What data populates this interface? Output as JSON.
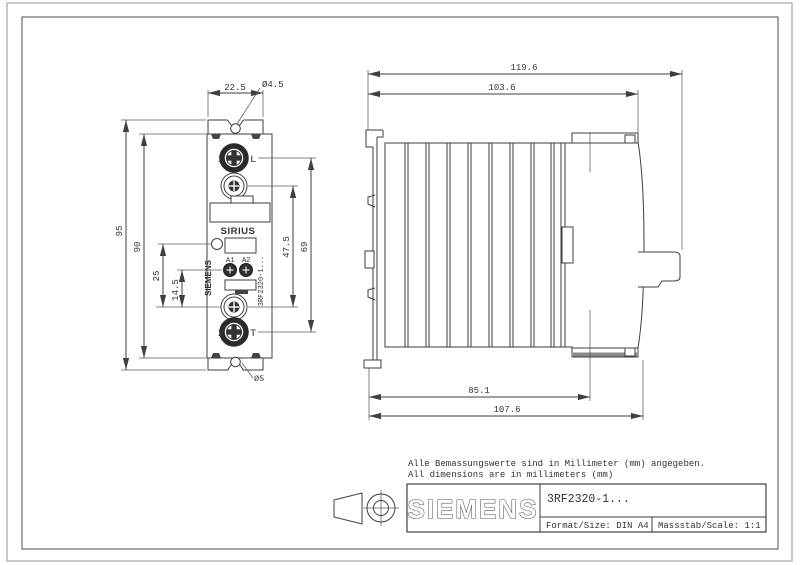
{
  "drawing": {
    "notes": {
      "de": "Alle Bemassungswerte sind in Millimeter (mm) angegeben.",
      "en": "All dimensions are in millimeters (mm)"
    },
    "front_view": {
      "dim_width_top": "22.5",
      "dim_hole_top": "Ø4.5",
      "dim_hole_bottom": "Ø5",
      "dim_height_overall": "95",
      "dim_height_body": "90",
      "dim_led_offset": "25",
      "dim_coil_offset": "14.5",
      "dim_screw_span": "47.5",
      "dim_terminal_span": "69",
      "terminal_top_num": "1",
      "terminal_top_label": "L",
      "terminal_bottom_num": "2",
      "terminal_bottom_label": "T",
      "product_line": "SIRIUS",
      "brand_vertical": "SIEMENS",
      "coil_a1": "A1",
      "coil_a2": "A2",
      "part_number_vertical": "3RF2320-1..."
    },
    "side_view": {
      "dim_depth_overall": "119.6",
      "dim_depth_body": "103.6",
      "dim_depth_din": "85.1",
      "dim_depth_back": "107.6"
    },
    "title_block": {
      "logo": "SIEMENS",
      "part_number": "3RF2320-1...",
      "format": "Format/Size: DIN A4",
      "scale": "Massstab/Scale: 1:1"
    }
  }
}
